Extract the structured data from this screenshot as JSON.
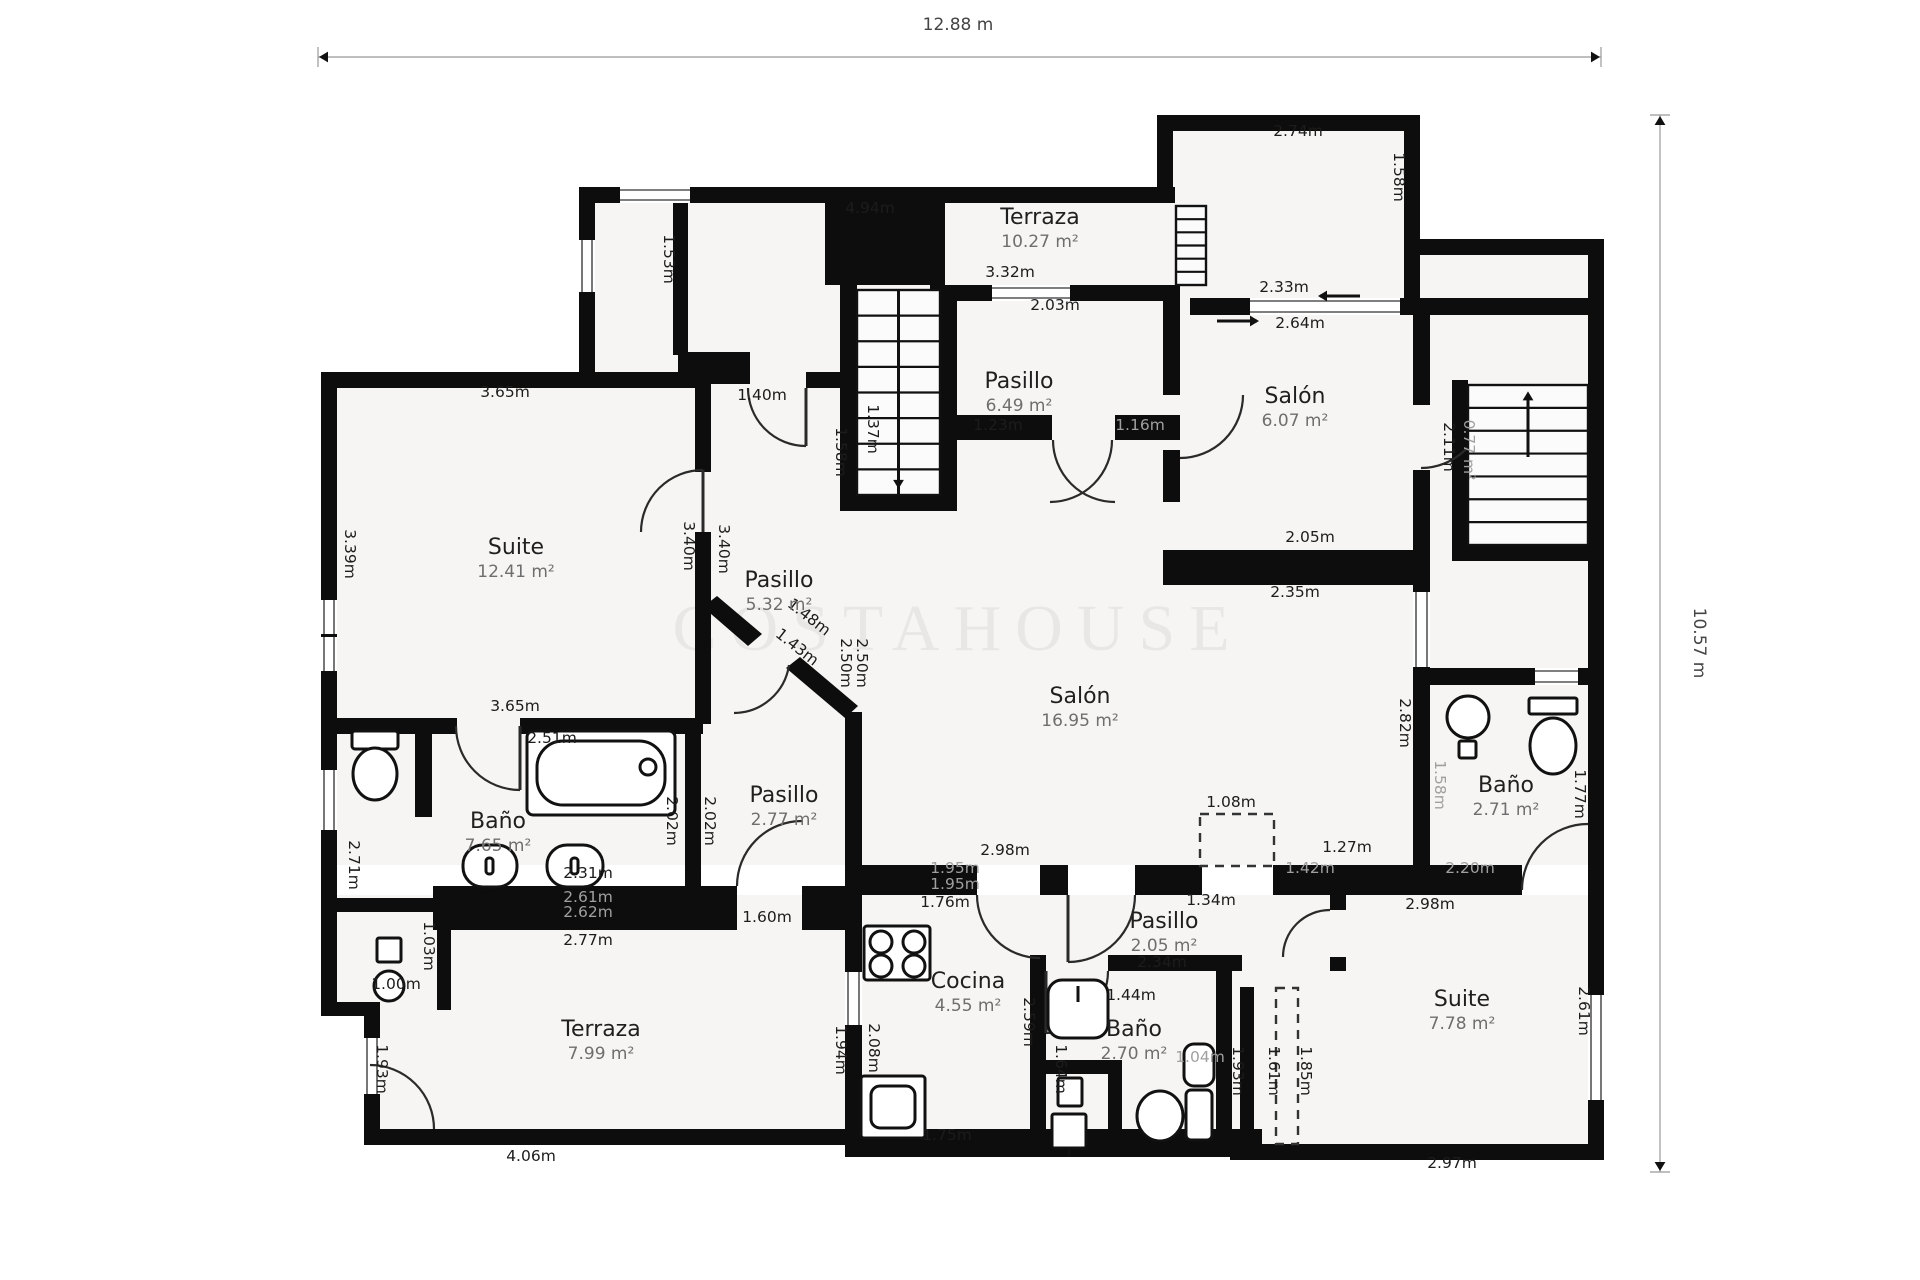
{
  "canvas": {
    "width": 1920,
    "height": 1280,
    "background": "#ffffff",
    "wall_color": "#0d0d0d",
    "room_fill": "#f6f5f4",
    "dim_color": "#1c1c1c",
    "dim_gray": "#a0a0a0",
    "room_name_color": "#1f1f1f",
    "room_area_color": "#6e6e6e",
    "door_color": "#2a2a2a"
  },
  "dimension_lines": {
    "top": {
      "label": "12.88 m",
      "x1": 318,
      "x2": 1601,
      "y": 57,
      "label_x": 958,
      "label_y": 30
    },
    "right": {
      "label": "10.57 m",
      "x": 1660,
      "y1": 115,
      "y2": 1172,
      "label_x": 1694,
      "label_y": 643
    }
  },
  "watermark": {
    "text": "COSTAHOUSE",
    "x": 958,
    "y": 650,
    "size": 66,
    "spacing": 14,
    "opacity": 0.05
  },
  "rooms": [
    {
      "name": "Terraza",
      "area": "10.27 m²",
      "x": 1040,
      "y": 224
    },
    {
      "name": "Pasillo",
      "area": "6.49 m²",
      "x": 1019,
      "y": 388
    },
    {
      "name": "Salón",
      "area": "6.07 m²",
      "x": 1295,
      "y": 403
    },
    {
      "name": "Suite",
      "area": "12.41 m²",
      "x": 516,
      "y": 554
    },
    {
      "name": "Pasillo",
      "area": "5.32 m²",
      "x": 779,
      "y": 587
    },
    {
      "name": "Salón",
      "area": "16.95 m²",
      "x": 1080,
      "y": 703
    },
    {
      "name": "Baño",
      "area": "7.65 m²",
      "x": 498,
      "y": 828
    },
    {
      "name": "Pasillo",
      "area": "2.77 m²",
      "x": 784,
      "y": 802
    },
    {
      "name": "Baño",
      "area": "2.71 m²",
      "x": 1506,
      "y": 792
    },
    {
      "name": "Cocina",
      "area": "4.55 m²",
      "x": 968,
      "y": 988
    },
    {
      "name": "Pasillo",
      "area": "2.05 m²",
      "x": 1164,
      "y": 928
    },
    {
      "name": "Baño",
      "area": "2.70 m²",
      "x": 1134,
      "y": 1036
    },
    {
      "name": "Suite",
      "area": "7.78 m²",
      "x": 1462,
      "y": 1006
    },
    {
      "name": "Terraza",
      "area": "7.99 m²",
      "x": 601,
      "y": 1036
    }
  ],
  "dims": [
    [
      "2.74m",
      1298,
      136,
      0,
      0
    ],
    [
      "4.94m",
      870,
      213,
      0,
      0
    ],
    [
      "1.58m",
      1394,
      177,
      90,
      0
    ],
    [
      "1.53m",
      664,
      259,
      90,
      0
    ],
    [
      "3.32m",
      1010,
      277,
      0,
      0
    ],
    [
      "2.03m",
      1055,
      310,
      0,
      0
    ],
    [
      "2.33m",
      1284,
      292,
      0,
      0
    ],
    [
      "2.64m",
      1300,
      328,
      0,
      0
    ],
    [
      "1.40m",
      762,
      400,
      0,
      0
    ],
    [
      "3.65m",
      505,
      397,
      0,
      0
    ],
    [
      "1.37m",
      868,
      429,
      90,
      0
    ],
    [
      "1.58m",
      836,
      452,
      90,
      0
    ],
    [
      "1.23m",
      998,
      430,
      0,
      0
    ],
    [
      "1.16m",
      1140,
      430,
      0,
      1
    ],
    [
      "2.05m",
      1310,
      542,
      0,
      0
    ],
    [
      "2.35m",
      1295,
      597,
      0,
      0
    ],
    [
      "2.11m",
      1444,
      447,
      90,
      0
    ],
    [
      "0.77 m²",
      1464,
      450,
      90,
      1
    ],
    [
      "3.39m",
      345,
      554,
      90,
      0
    ],
    [
      "3.40m",
      684,
      546,
      90,
      0
    ],
    [
      "3.40m",
      719,
      549,
      90,
      0
    ],
    [
      "2.50m",
      841,
      663,
      90,
      0
    ],
    [
      "2.50m",
      857,
      663,
      90,
      0
    ],
    [
      "1.48m",
      806,
      621,
      38,
      0
    ],
    [
      "1.43m",
      794,
      651,
      38,
      0
    ],
    [
      "3.65m",
      515,
      711,
      0,
      0
    ],
    [
      "2.82m",
      1400,
      723,
      90,
      0
    ],
    [
      "2.51m",
      552,
      743,
      0,
      0
    ],
    [
      "2.02m",
      667,
      821,
      90,
      0
    ],
    [
      "2.02m",
      705,
      821,
      90,
      0
    ],
    [
      "2.71m",
      349,
      865,
      90,
      0
    ],
    [
      "2.31m",
      588,
      878,
      0,
      0
    ],
    [
      "2.61m",
      588,
      902,
      0,
      1
    ],
    [
      "2.62m",
      588,
      917,
      0,
      1
    ],
    [
      "2.77m",
      588,
      945,
      0,
      0
    ],
    [
      "1.03m",
      424,
      946,
      90,
      0
    ],
    [
      "1.00m",
      396,
      989,
      0,
      0
    ],
    [
      "2.98m",
      1005,
      855,
      0,
      0
    ],
    [
      "1.95m",
      955,
      873,
      0,
      1
    ],
    [
      "1.95m",
      955,
      889,
      0,
      1
    ],
    [
      "1.76m",
      945,
      907,
      0,
      0
    ],
    [
      "1.34m",
      1211,
      905,
      0,
      0
    ],
    [
      "1.08m",
      1231,
      807,
      0,
      0
    ],
    [
      "1.27m",
      1347,
      852,
      0,
      0
    ],
    [
      "1.42m",
      1310,
      873,
      0,
      1
    ],
    [
      "2.20m",
      1470,
      873,
      0,
      1
    ],
    [
      "2.98m",
      1430,
      909,
      0,
      0
    ],
    [
      "1.60m",
      767,
      922,
      0,
      0
    ],
    [
      "2.34m",
      1162,
      967,
      0,
      0
    ],
    [
      "1.44m",
      1131,
      1000,
      0,
      0
    ],
    [
      "1.64m",
      1056,
      1069,
      90,
      0
    ],
    [
      "1.04m",
      1200,
      1062,
      0,
      1
    ],
    [
      "1.93m",
      1233,
      1071,
      90,
      0
    ],
    [
      "1.61m",
      1269,
      1071,
      90,
      0
    ],
    [
      "1.85m",
      1301,
      1071,
      90,
      0
    ],
    [
      "2.61m",
      1579,
      1011,
      90,
      0
    ],
    [
      "2.97m",
      1452,
      1168,
      0,
      0
    ],
    [
      "1.58m",
      1435,
      785,
      90,
      1
    ],
    [
      "1.77m",
      1575,
      794,
      90,
      0
    ],
    [
      "2.59m",
      1024,
      1022,
      90,
      0
    ],
    [
      "2.08m",
      869,
      1048,
      90,
      0
    ],
    [
      "1.94m",
      836,
      1050,
      90,
      0
    ],
    [
      "1.75m",
      947,
      1140,
      0,
      0
    ],
    [
      "4.06m",
      531,
      1161,
      0,
      0
    ],
    [
      "1.93m",
      377,
      1069,
      90,
      0
    ]
  ],
  "fills": [
    [
      595,
      203,
      580,
      100
    ],
    [
      595,
      303,
      230,
      85
    ],
    [
      1173,
      131,
      231,
      170
    ],
    [
      1404,
      255,
      184,
      60
    ],
    [
      825,
      285,
      763,
      103
    ],
    [
      337,
      388,
      1251,
      477
    ],
    [
      364,
      895,
      1224,
      250
    ],
    [
      337,
      895,
      27,
      118
    ]
  ],
  "walls": [
    [
      579,
      187,
      596,
      16
    ],
    [
      1157,
      115,
      16,
      88
    ],
    [
      1157,
      115,
      263,
      16
    ],
    [
      1404,
      115,
      16,
      140
    ],
    [
      1404,
      239,
      200,
      16
    ],
    [
      1404,
      255,
      16,
      43
    ],
    [
      1588,
      239,
      16,
      921
    ],
    [
      579,
      187,
      16,
      194
    ],
    [
      321,
      372,
      382,
      16
    ],
    [
      321,
      372,
      16,
      528
    ],
    [
      673,
      203,
      15,
      152
    ],
    [
      678,
      352,
      72,
      32
    ],
    [
      806,
      372,
      36,
      16
    ],
    [
      321,
      892,
      16,
      124
    ],
    [
      337,
      898,
      112,
      14
    ],
    [
      437,
      898,
      14,
      112
    ],
    [
      321,
      1002,
      58,
      14
    ],
    [
      364,
      1002,
      16,
      143
    ],
    [
      364,
      1129,
      498,
      16
    ],
    [
      695,
      372,
      16,
      100
    ],
    [
      695,
      532,
      16,
      192
    ],
    [
      321,
      718,
      136,
      16
    ],
    [
      520,
      718,
      183,
      16
    ],
    [
      685,
      733,
      16,
      155
    ],
    [
      415,
      733,
      17,
      84
    ],
    [
      433,
      886,
      304,
      44
    ],
    [
      802,
      886,
      60,
      44
    ],
    [
      845,
      712,
      17,
      180
    ],
    [
      845,
      892,
      17,
      80
    ],
    [
      845,
      1025,
      17,
      104
    ],
    [
      825,
      203,
      120,
      82
    ],
    [
      840,
      285,
      17,
      222
    ],
    [
      940,
      285,
      17,
      222
    ],
    [
      840,
      495,
      117,
      16
    ],
    [
      930,
      285,
      250,
      16
    ],
    [
      945,
      415,
      107,
      25
    ],
    [
      1115,
      415,
      65,
      25
    ],
    [
      1163,
      285,
      17,
      110
    ],
    [
      1163,
      450,
      17,
      52
    ],
    [
      1163,
      550,
      257,
      35
    ],
    [
      1413,
      315,
      17,
      90
    ],
    [
      1413,
      470,
      17,
      215
    ],
    [
      1190,
      298,
      60,
      17
    ],
    [
      1400,
      298,
      204,
      17
    ],
    [
      1452,
      380,
      16,
      181
    ],
    [
      1452,
      545,
      152,
      16
    ],
    [
      1413,
      668,
      191,
      17
    ],
    [
      1413,
      685,
      17,
      205
    ],
    [
      862,
      865,
      115,
      30
    ],
    [
      1040,
      865,
      28,
      30
    ],
    [
      1135,
      865,
      67,
      30
    ],
    [
      1273,
      865,
      249,
      30
    ],
    [
      1030,
      955,
      16,
      16
    ],
    [
      1108,
      955,
      134,
      16
    ],
    [
      1030,
      971,
      16,
      186
    ],
    [
      1216,
      971,
      16,
      186
    ],
    [
      1040,
      1060,
      82,
      14
    ],
    [
      1108,
      1060,
      14,
      97
    ],
    [
      1330,
      895,
      16,
      15
    ],
    [
      1330,
      957,
      16,
      14
    ],
    [
      1240,
      987,
      14,
      157
    ],
    [
      845,
      1129,
      417,
      28
    ],
    [
      1230,
      1144,
      374,
      16
    ]
  ],
  "polys": [
    "703,607 717,596 762,634 748,646",
    "786,668 800,657 858,706 845,718"
  ],
  "windows": [
    [
      579,
      240,
      16,
      52
    ],
    [
      321,
      600,
      16,
      34
    ],
    [
      321,
      637,
      16,
      34
    ],
    [
      321,
      770,
      16,
      60
    ],
    [
      364,
      1038,
      16,
      56
    ],
    [
      845,
      972,
      17,
      53
    ],
    [
      620,
      187,
      70,
      16
    ],
    [
      992,
      285,
      78,
      16
    ],
    [
      1250,
      298,
      150,
      17
    ],
    [
      1413,
      592,
      17,
      75
    ],
    [
      1535,
      668,
      43,
      17
    ],
    [
      1588,
      995,
      16,
      105
    ]
  ],
  "doors": [
    "M 641 532 A 62 62 0 0 1 703 470",
    "M 456 726 A 64 64 0 0 0 520 790",
    "M 748 388 A 58 58 0 0 0 806 446",
    "M 1112 440 A 62 62 0 0 1 1050 502",
    "M 1053 440 A 62 62 0 0 0 1115 502",
    "M 1180 458 A 63 63 0 0 0 1243 395",
    "M 1421 468 A 63 63 0 0 0 1484 405",
    "M 737 886 A 65 65 0 0 1 802 821",
    "M 789 665 A 56 56 0 0 1 734 713",
    "M 977 895 A 63 63 0 0 0 1040 958",
    "M 1135 895 A 67 67 0 0 1 1068 962",
    "M 1108 971 A 62 62 0 0 1 1046 1033",
    "M 1330 910 A 47 47 0 0 0 1283 957",
    "M 1522 890 A 66 66 0 0 1 1588 824",
    "M 370 1065 A 64 64 0 0 1 434 1129"
  ],
  "door_leaves": [
    [
      703,
      470,
      703,
      532
    ],
    [
      520,
      726,
      520,
      790
    ],
    [
      806,
      388,
      806,
      446
    ],
    [
      1046,
      971,
      1046,
      1033
    ],
    [
      1068,
      895,
      1068,
      962
    ]
  ],
  "dashed": [
    [
      1200,
      814,
      74,
      52
    ],
    [
      1276,
      988,
      22,
      156
    ]
  ],
  "stairs": [
    {
      "x": 857,
      "y": 290,
      "w": 83,
      "h": 205,
      "treads": 7,
      "rail": true,
      "arrow": "down"
    },
    {
      "x": 1468,
      "y": 385,
      "w": 120,
      "h": 160,
      "treads": 6,
      "rail": false,
      "arrow": "up"
    },
    {
      "x": 1176,
      "y": 206,
      "w": 30,
      "h": 79,
      "treads": 5,
      "rail": false,
      "arrow": ""
    }
  ],
  "entry_arrows": [
    {
      "x1": 1360,
      "y1": 296,
      "x2": 1320,
      "y2": 296
    },
    {
      "x1": 1217,
      "y1": 321,
      "x2": 1257,
      "y2": 321
    }
  ],
  "fixtures": [
    {
      "t": "rect",
      "x": 527,
      "y": 731,
      "w": 148,
      "h": 84,
      "rx": 6
    },
    {
      "t": "rect",
      "x": 537,
      "y": 741,
      "w": 128,
      "h": 64,
      "rx": 26
    },
    {
      "t": "circle",
      "cx": 648,
      "cy": 767,
      "r": 8
    },
    {
      "t": "rect",
      "x": 352,
      "y": 731,
      "w": 46,
      "h": 18,
      "rx": 3
    },
    {
      "t": "ellipse",
      "cx": 375,
      "cy": 774,
      "rx": 22,
      "ry": 26
    },
    {
      "t": "rect",
      "x": 463,
      "y": 845,
      "w": 54,
      "h": 42,
      "rx": 20
    },
    {
      "t": "rect",
      "x": 547,
      "y": 845,
      "w": 56,
      "h": 42,
      "rx": 20
    },
    {
      "t": "rect",
      "x": 486,
      "y": 858,
      "w": 7,
      "h": 16,
      "rx": 3
    },
    {
      "t": "rect",
      "x": 571,
      "y": 858,
      "w": 7,
      "h": 16,
      "rx": 3
    },
    {
      "t": "rect",
      "x": 377,
      "y": 938,
      "w": 24,
      "h": 24,
      "rx": 2
    },
    {
      "t": "circle",
      "cx": 389,
      "cy": 986,
      "r": 15
    },
    {
      "t": "rect",
      "x": 864,
      "y": 926,
      "w": 66,
      "h": 54,
      "rx": 3
    },
    {
      "t": "circle",
      "cx": 881,
      "cy": 942,
      "r": 11
    },
    {
      "t": "circle",
      "cx": 914,
      "cy": 942,
      "r": 11
    },
    {
      "t": "circle",
      "cx": 881,
      "cy": 966,
      "r": 11
    },
    {
      "t": "circle",
      "cx": 914,
      "cy": 966,
      "r": 11
    },
    {
      "t": "rect",
      "x": 861,
      "y": 1076,
      "w": 64,
      "h": 62,
      "rx": 3
    },
    {
      "t": "rect",
      "x": 871,
      "y": 1086,
      "w": 44,
      "h": 42,
      "rx": 9
    },
    {
      "t": "rect",
      "x": 1048,
      "y": 980,
      "w": 60,
      "h": 58,
      "rx": 14
    },
    {
      "t": "line",
      "x1": 1078,
      "y1": 986,
      "x2": 1078,
      "y2": 1002
    },
    {
      "t": "ellipse",
      "cx": 1160,
      "cy": 1116,
      "rx": 23,
      "ry": 25
    },
    {
      "t": "rect",
      "x": 1186,
      "y": 1090,
      "w": 26,
      "h": 50,
      "rx": 5
    },
    {
      "t": "rect",
      "x": 1184,
      "y": 1044,
      "w": 30,
      "h": 42,
      "rx": 10
    },
    {
      "t": "circle",
      "cx": 1468,
      "cy": 717,
      "r": 21
    },
    {
      "t": "rect",
      "x": 1459,
      "y": 741,
      "w": 17,
      "h": 17,
      "rx": 2
    },
    {
      "t": "rect",
      "x": 1529,
      "y": 698,
      "w": 48,
      "h": 16,
      "rx": 2
    },
    {
      "t": "ellipse",
      "cx": 1553,
      "cy": 746,
      "rx": 23,
      "ry": 28
    },
    {
      "t": "rect",
      "x": 1058,
      "y": 1078,
      "w": 24,
      "h": 28,
      "rx": 2
    },
    {
      "t": "rect",
      "x": 1052,
      "y": 1114,
      "w": 34,
      "h": 34,
      "rx": 2
    },
    {
      "t": "line",
      "x1": 1069,
      "y1": 1148,
      "x2": 1069,
      "y2": 1157
    }
  ]
}
